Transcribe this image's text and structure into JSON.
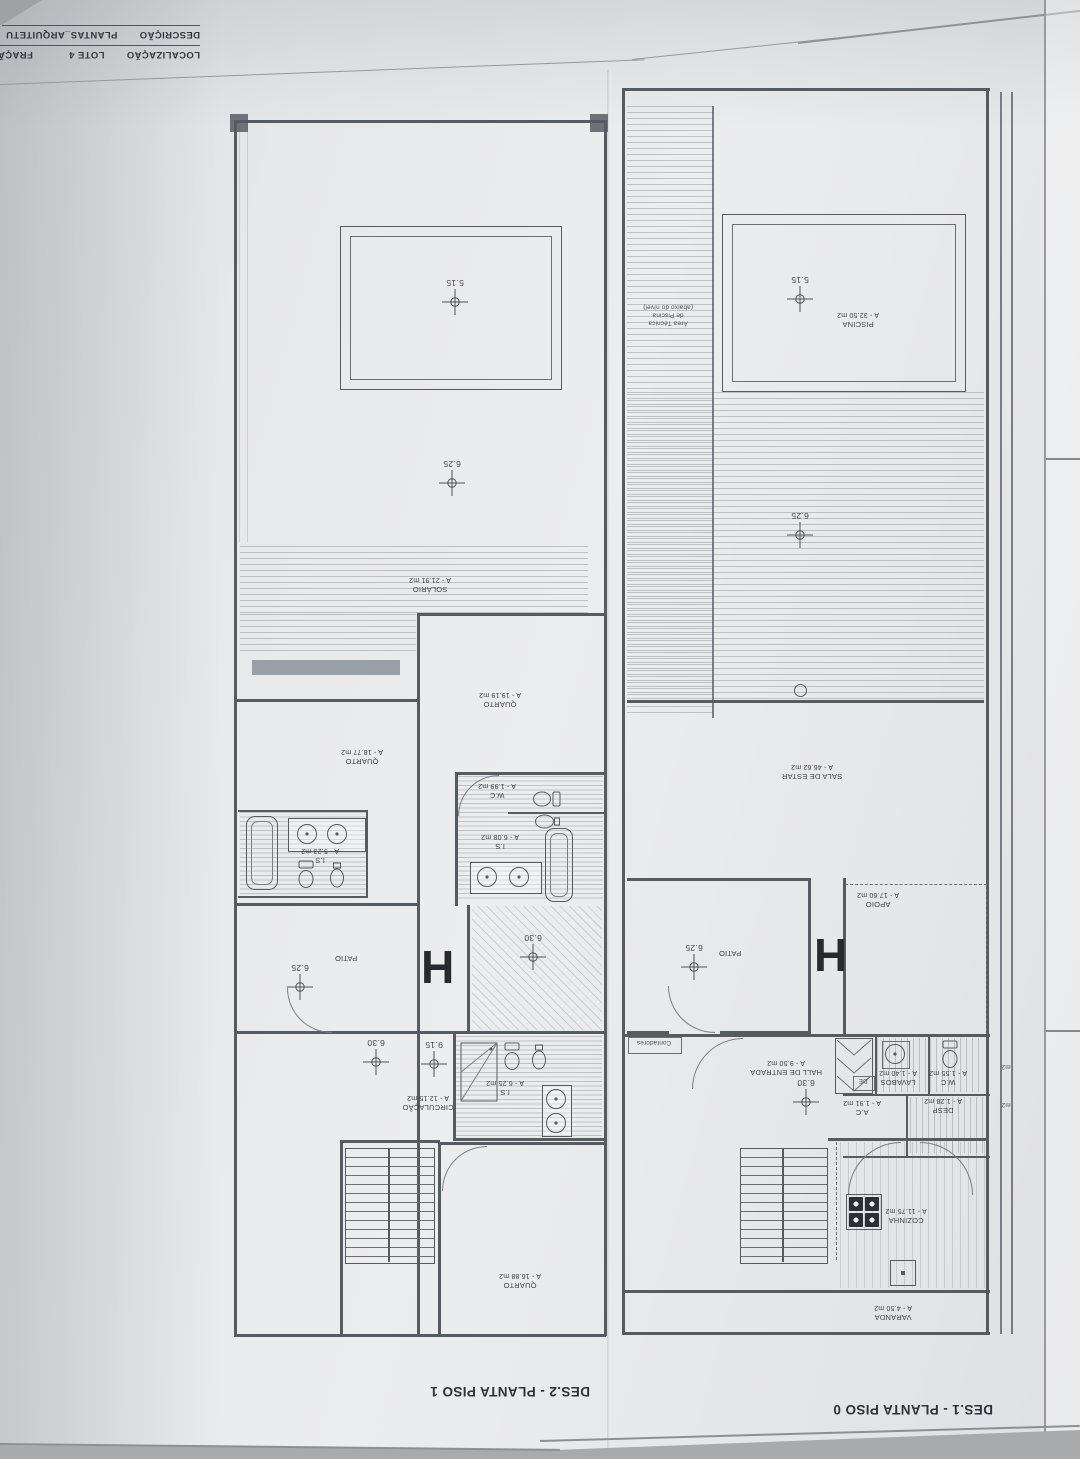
{
  "title_block": {
    "descricao_label": "DESCRIÇÃO",
    "descricao_value": "PLANTAS_ARQUITETU",
    "localizacao_label": "LOCALIZAÇÃO",
    "localizacao_value": "LOTE 4",
    "fracao_value": "FRAÇÃO \"H\"_MORAD"
  },
  "piso1": {
    "caption": "DES.2 - PLANTA PISO 1",
    "unit_marker": "H",
    "dims": {
      "void": "5.15",
      "terrace": "6.25",
      "hall_upper": "6.30",
      "patio": "6.25",
      "circ_left": "6.30",
      "circ_right": "9.15"
    },
    "rooms": {
      "solario": {
        "name": "SOLÁRIO",
        "area": "A - 21.91 m2"
      },
      "quarto_sup": {
        "name": "QUARTO",
        "area": "A - 19.19 m2"
      },
      "quarto_esq": {
        "name": "QUARTO",
        "area": "A - 18.77 m2"
      },
      "is_esq": {
        "name": "I.S",
        "area": "A - 5.23 m2"
      },
      "wc": {
        "name": "W.C",
        "area": "A - 1.99 m2"
      },
      "is_centro": {
        "name": "I.S",
        "area": "A - 6.08 m2"
      },
      "patio": {
        "name": "PATIO"
      },
      "circulacao": {
        "name": "CIRCULAÇÃO",
        "area": "A - 12.15 m2"
      },
      "is_inf": {
        "name": "I.S",
        "area": "A - 6.25 m2"
      },
      "quarto_inf": {
        "name": "QUARTO",
        "area": "A - 16.88 m2"
      }
    }
  },
  "piso0": {
    "caption": "DES.1 - PLANTA PISO 0",
    "unit_marker": "H",
    "dims": {
      "pool": "5.15",
      "deck": "6.25",
      "patio": "6.25",
      "hall": "6.30"
    },
    "rooms": {
      "piscina": {
        "name": "PISCINA",
        "area": "A - 32.50 m2"
      },
      "area_tecnica": {
        "line1": "Área Técnica",
        "line2": "de Piscina",
        "line3": "(abaixo do nível)"
      },
      "sala": {
        "name": "SALA DE ESTAR",
        "area": "A - 46.62 m2"
      },
      "apoio": {
        "name": "APOIO",
        "area": "A - 17.60 m2"
      },
      "patio": {
        "name": "PATIO"
      },
      "contadores": "Contadores",
      "hall": {
        "name": "HALL DE ENTRADA",
        "area": "A - 9.50 m2"
      },
      "lavabos": {
        "name": "LAVABOS",
        "area": "A - 1.40 m2"
      },
      "wc": {
        "name": "W.C",
        "area": "A - 1.55 m2"
      },
      "de": "DE",
      "ac": {
        "name": "A.C",
        "area": "A - 1.91 m2"
      },
      "desp": {
        "name": "DESP",
        "area": "A - 1.28 m2"
      },
      "cozinha": {
        "name": "COZINHA",
        "area": "A - 11.75 m2"
      },
      "varanda": {
        "name": "VARANDA",
        "area": "A - 4.50 m2"
      },
      "edge_fragment_a": "m2",
      "edge_fragment_b": "m2"
    }
  }
}
